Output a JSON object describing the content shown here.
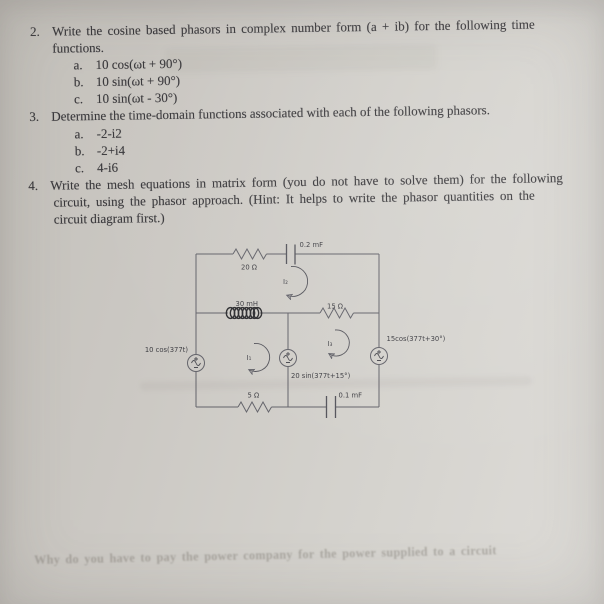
{
  "problems": {
    "p2": {
      "number": "2.",
      "line1": "Write the cosine based phasors in complex number form (a + ib) for the following time",
      "line2": "functions.",
      "items": [
        {
          "label": "a.",
          "text": "10 cos(ωt + 90°)"
        },
        {
          "label": "b.",
          "text": "10 sin(ωt + 90°)"
        },
        {
          "label": "c.",
          "text": "10 sin(ωt - 30°)"
        }
      ]
    },
    "p3": {
      "number": "3.",
      "line1": "Determine the time-domain functions associated with each of the following phasors.",
      "items": [
        {
          "label": "a.",
          "text": "-2-i2"
        },
        {
          "label": "b.",
          "text": "-2+i4"
        },
        {
          "label": "c.",
          "text": "4-i6"
        }
      ]
    },
    "p4": {
      "number": "4.",
      "line1": "Write the mesh equations in matrix form (you do not have to solve them) for the following",
      "line2": "circuit, using the phasor approach. (Hint: It helps to write the phasor quantities on the",
      "line3": "circuit diagram first.)"
    }
  },
  "circuit": {
    "resistor_20": "20 Ω",
    "capacitor_02": "0.2 mF",
    "inductor_30": "30 mH",
    "resistor_15": "15 Ω",
    "resistor_5": "5 Ω",
    "capacitor_01": "0.1 mF",
    "source_left": "10 cos(377t)",
    "source_middle": "20 sin(377t+15°)",
    "source_right": "15cos(377t+30°)",
    "mesh_i1": "I₁",
    "mesh_i2": "I₂",
    "mesh_i3": "I₃"
  },
  "bleedthrough": {
    "bottom_line": "Why do you have to pay the power company for the power supplied to a circuit"
  }
}
